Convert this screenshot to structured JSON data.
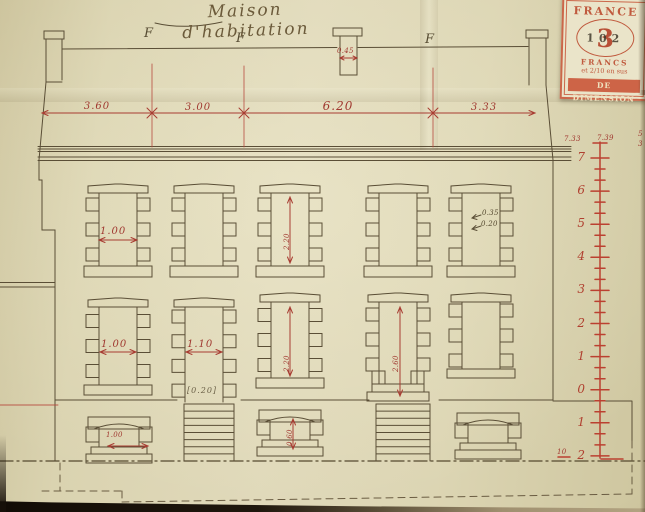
{
  "title": "Maison d'habitation",
  "stamp": {
    "country": "FRANCE",
    "denomination": "3",
    "overprint": "102",
    "currency": "FRANCS",
    "surcharge": "et 2/10 en sus",
    "caption": "DE DIMENSION"
  },
  "top_dimension_labels": [
    "3.60",
    "3.00",
    "6.20",
    "3.33"
  ],
  "axis_letters": [
    "F",
    "F",
    "F"
  ],
  "chimney_dimension": "0.45",
  "window_dimensions": {
    "r1c1": "1.00",
    "r1c3": "2.20",
    "r1c5_a": "0.35",
    "r1c5_b": "0.20",
    "r2c1": "1.00",
    "r2c2": "1.10",
    "r2c2_note": "[0.20]",
    "r2c3": "2.20",
    "r2c4": "2.60",
    "b1": "1.00",
    "b3": "0.60"
  },
  "scale": {
    "header_left": "7.33",
    "header_right": "7.39",
    "labels": [
      "7",
      "6",
      "5",
      "4",
      "3",
      "2",
      "1",
      "0",
      "1",
      "2"
    ],
    "bottom_note": "10",
    "edge_marks": [
      "5",
      "3"
    ]
  },
  "colors": {
    "ink": "#5a4e36",
    "dimension_red": "#a83c32",
    "scale_red": "#bb4030",
    "stamp_red": "#cb674a",
    "paper": "#dcd5b3"
  }
}
